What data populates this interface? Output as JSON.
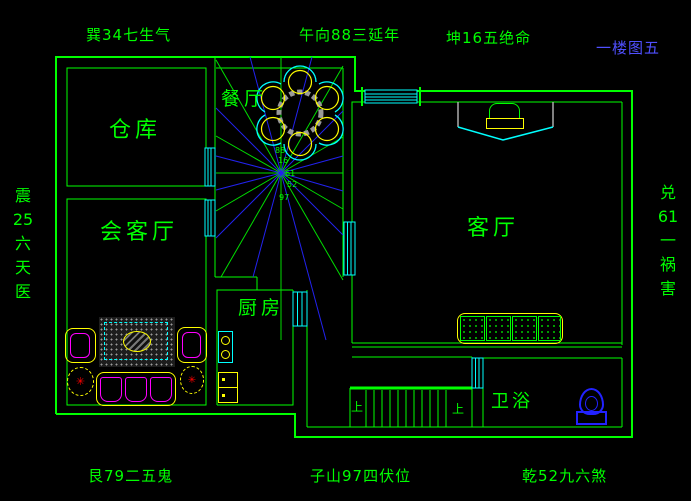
{
  "title": "一楼图五",
  "annotations": {
    "top_left": "巽34七生气",
    "top_center": "午向88三延年",
    "top_right": "坤16五绝命",
    "bottom_left": "艮79二五鬼",
    "bottom_center": "子山97四伏位",
    "bottom_right": "乾52九六煞",
    "left_column": {
      "c1": "震",
      "c2": "25",
      "c3": "六",
      "c4": "天",
      "c5": "医"
    },
    "right_column": {
      "c1": "兑",
      "c2": "61",
      "c3": "一",
      "c4": "祸",
      "c5": "害"
    }
  },
  "rooms": {
    "warehouse": "仓库",
    "dining": "餐厅",
    "reception": "会客厅",
    "kitchen": "厨房",
    "living": "客厅",
    "bathroom": "卫浴"
  },
  "stairs": {
    "up_left": "上",
    "up_right": "上"
  },
  "compass_numbers": {
    "n1": "88",
    "n2": "16",
    "n3": "61",
    "n4": "52",
    "n5": "97"
  },
  "colors": {
    "wall_green": "#00ff00",
    "window_cyan": "#00ffff",
    "ray_blue": "#2222ee",
    "furniture_yellow": "#ffff00",
    "accent_magenta": "#ff00ff",
    "hatch_gray": "#999999",
    "fixture_blue": "#2222ff",
    "title_blue": "#5050ff"
  }
}
